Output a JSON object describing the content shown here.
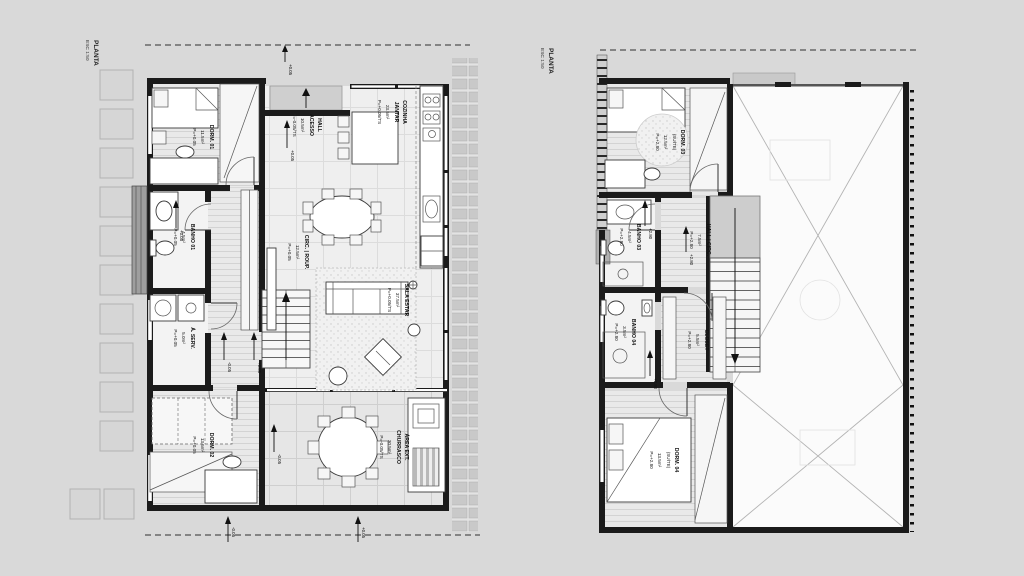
{
  "plan1": {
    "title": "PLANTA",
    "scale": "ESC 1:50",
    "rooms": {
      "dorm01": {
        "name": "DORM. 01",
        "area": "11.5m²",
        "level": "P=+0.05"
      },
      "hall": {
        "name": "HALL",
        "name2": "ACESSO",
        "area": "10.5m²",
        "level": "P=-0.05/TS"
      },
      "cozinha": {
        "name": "COZINHA",
        "name2": "JANTAR",
        "area": "23.5m²",
        "level": "P=+0.05/TS"
      },
      "banho01": {
        "name": "BANHO 01",
        "area": "4.5m²",
        "level": "P=+0.05"
      },
      "circ": {
        "name": "CIRC. | ROUP.",
        "area": "12.5m²",
        "level": "P=+0.05"
      },
      "serv": {
        "name": "Á. SERV.",
        "area": "5.0m²",
        "level": "P=+0.05"
      },
      "dorm02": {
        "name": "DORM. 02",
        "area": "13.5m²",
        "level": "P=+0.05"
      },
      "sala": {
        "name": "SALA ESTAR",
        "area": "37.5m²",
        "level": "P=+0.05/TS"
      },
      "churrasco": {
        "name": "ÁREA EXT.",
        "name2": "CHURRASCO",
        "area": "30.5m²",
        "level": "P=-0.05/TS"
      }
    },
    "markers": {
      "roof": "+0.05",
      "entry": "+0.05",
      "banho": "+0.05",
      "serv_door": "-0.05",
      "sala_door": "+0.05",
      "churrasco": "-0.05",
      "bottom_left": "-0.05",
      "bottom_right": "+0.05"
    }
  },
  "plan2": {
    "title": "PLANTA",
    "scale": "ESC 1:50",
    "rooms": {
      "dorm03": {
        "name": "DORM. 03",
        "sub": "(SUÍTE)",
        "area": "12.5m²",
        "level": "P=+2.80"
      },
      "banho03": {
        "name": "BANHO 03",
        "area": "4.5m²",
        "level": "P=+2.80"
      },
      "hall": {
        "name": "HALL | CIRC.",
        "area": "7.5m²",
        "level": "P=+2.80"
      },
      "banho04": {
        "name": "BANHO 04",
        "area": "3.5m²",
        "level": "P=+2.80"
      },
      "closet": {
        "name": "CLOSET",
        "area": "5.5m²",
        "level": "P=+2.80"
      },
      "dorm04": {
        "name": "DORM. 04",
        "sub": "(SUÍTE)",
        "area": "13.5m²",
        "level": "P=+2.80"
      }
    },
    "markers": {
      "banho": "+2.80",
      "hall": "+2.80",
      "closet": "+2.80"
    }
  }
}
